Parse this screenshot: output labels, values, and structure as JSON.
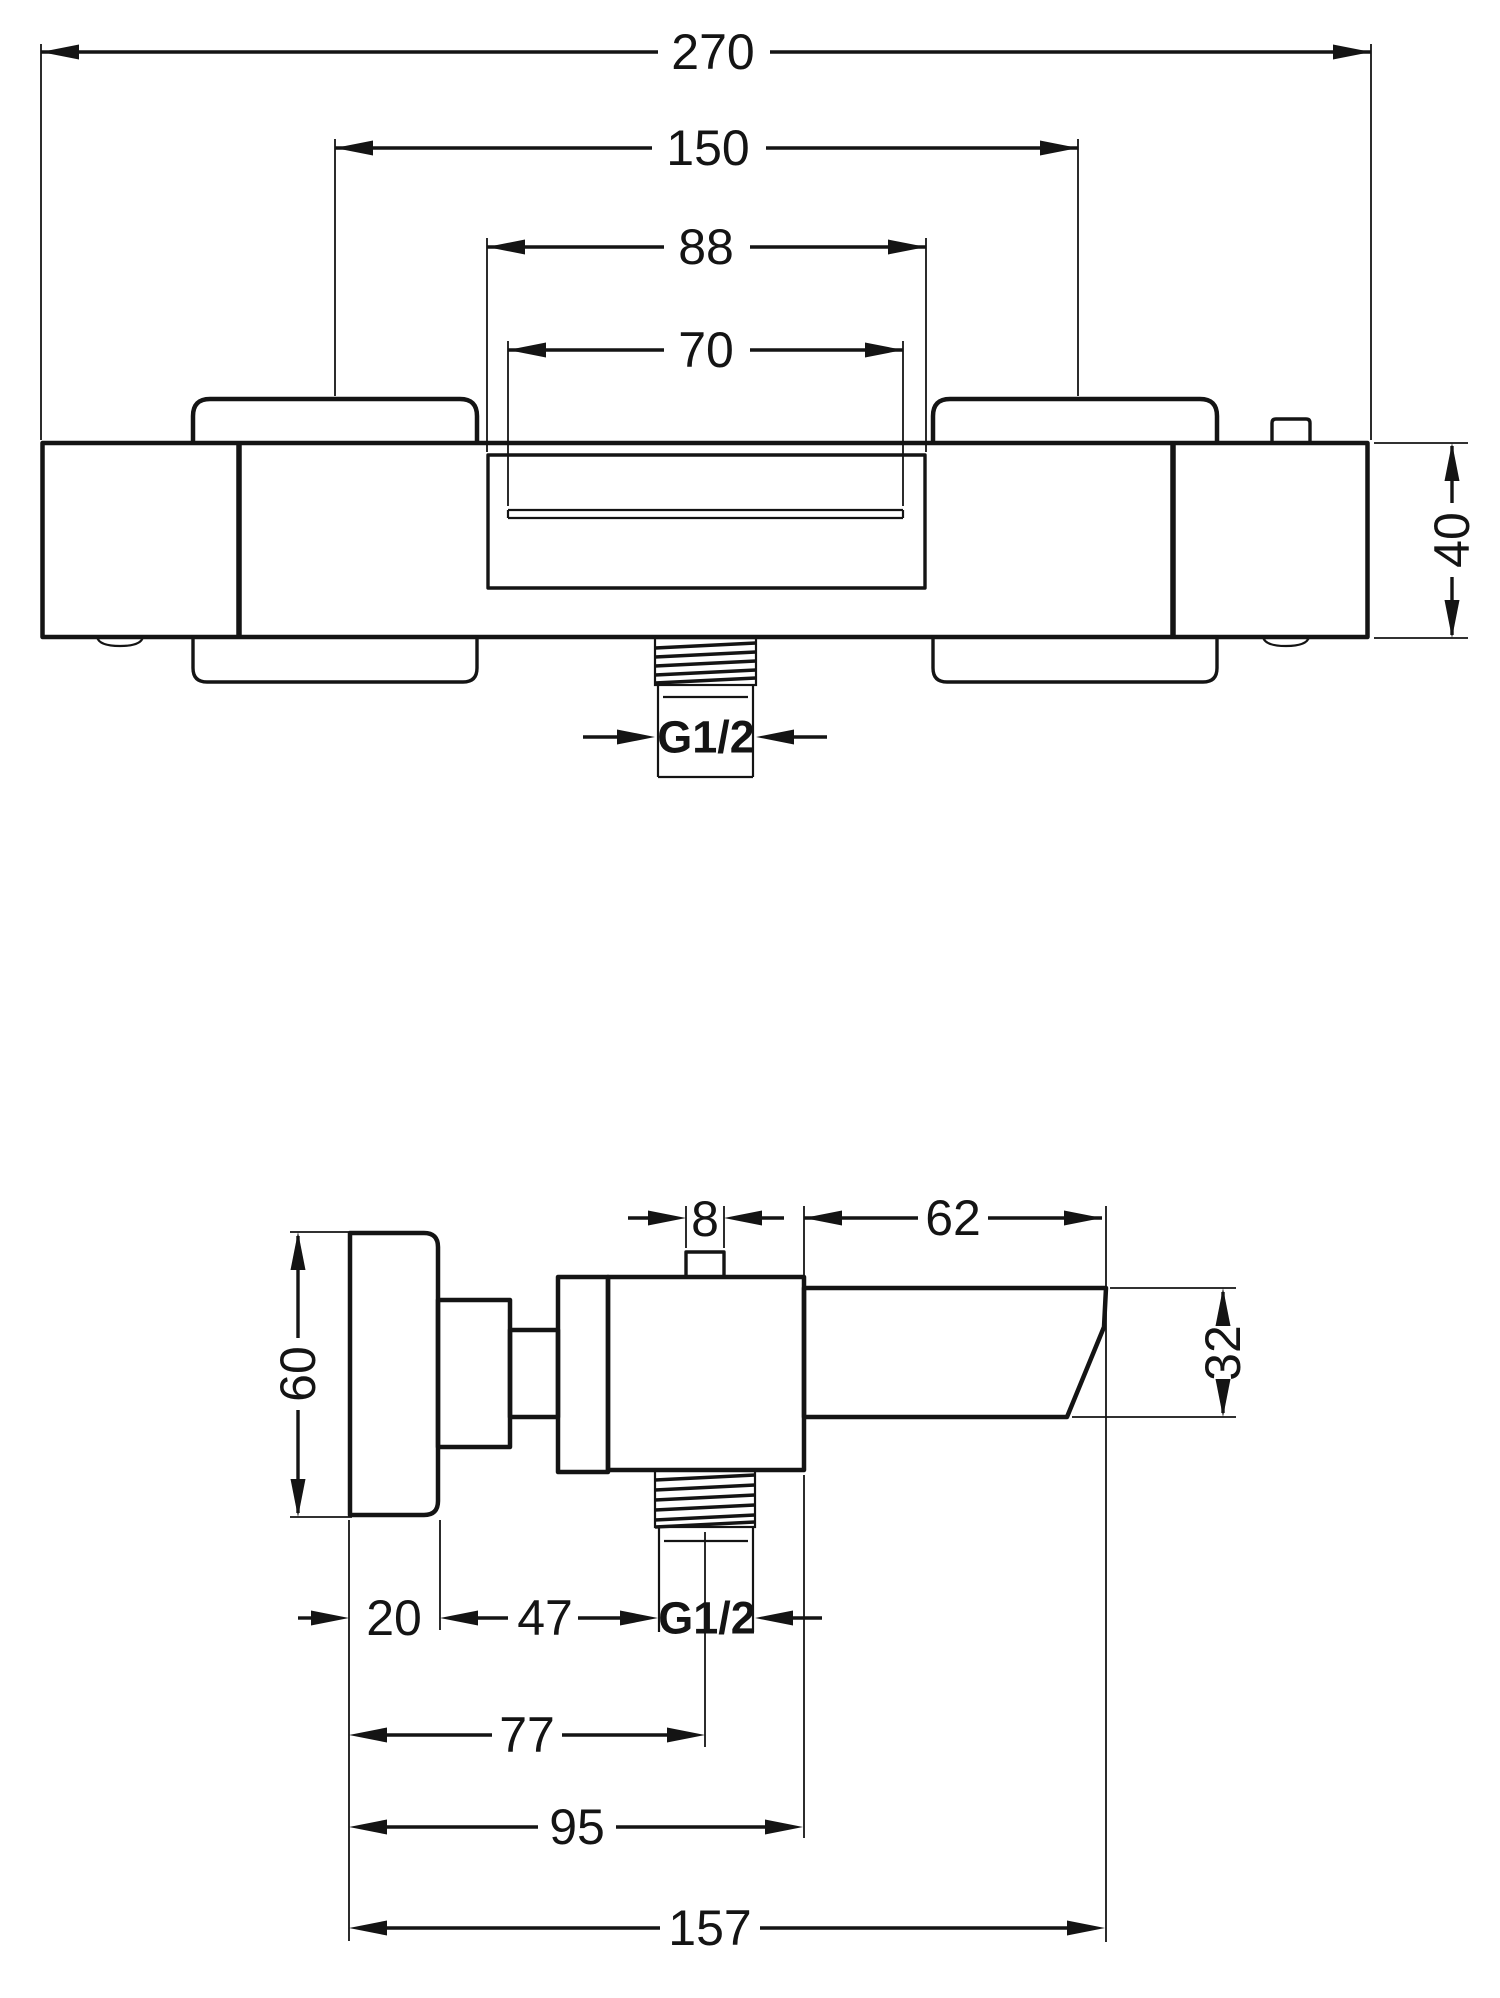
{
  "drawing": {
    "line_color": "#141414",
    "background_color": "#ffffff",
    "front": {
      "overall_width": "270",
      "handle_spacing": "150",
      "spout_recess_outer": "88",
      "spout_opening": "70",
      "body_height": "40",
      "outlet_thread": "G1/2"
    },
    "side": {
      "diverter_width": "8",
      "spout_length": "62",
      "handle_height": "60",
      "spout_height": "32",
      "handle_depth": "20",
      "handle_to_thread": "47",
      "outlet_thread": "G1/2",
      "depth_to_outlet_center": "77",
      "depth_to_body_face": "95",
      "total_depth": "157"
    }
  }
}
